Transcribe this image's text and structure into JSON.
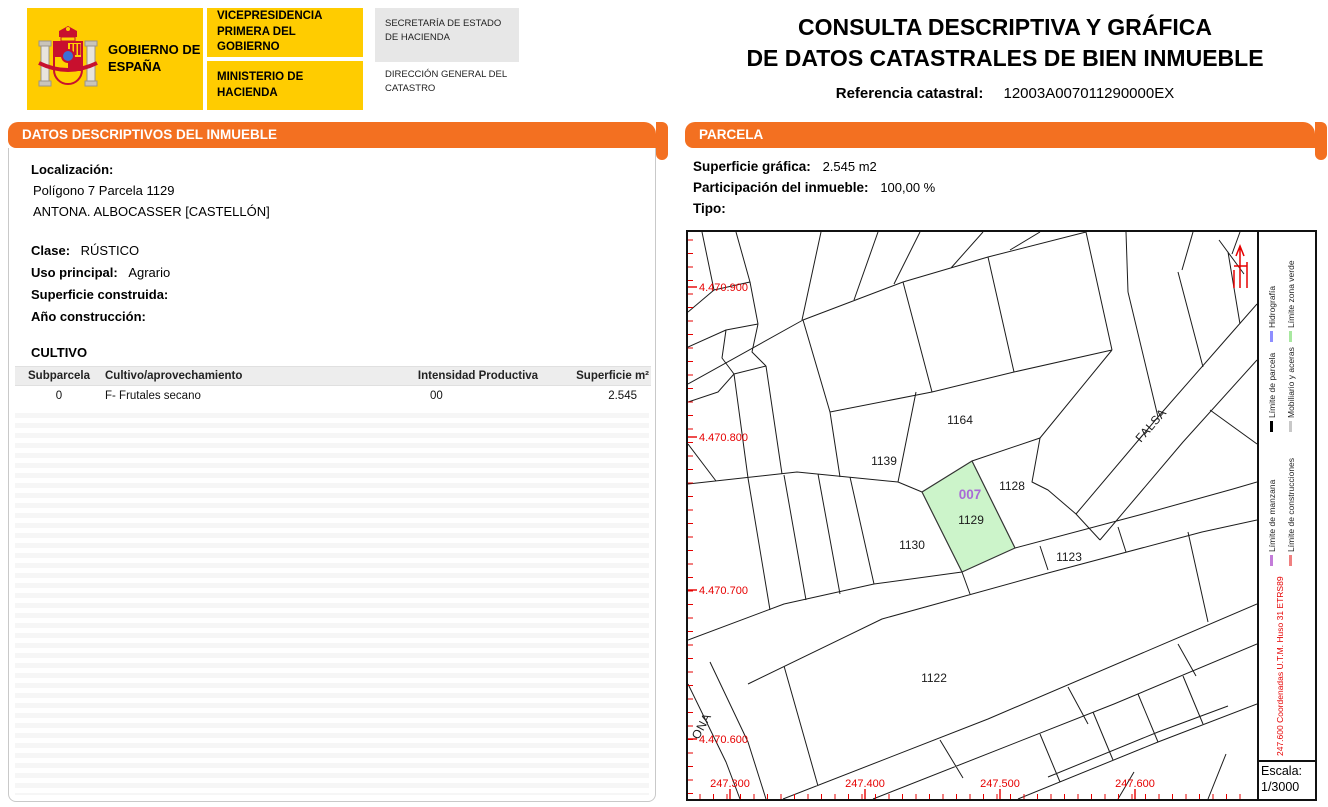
{
  "colors": {
    "accent_orange": "#F37021",
    "brand_yellow": "#FFCC00",
    "map_red": "#E60000",
    "parcel_green_fill": "#CCF4CA",
    "parcel_code_purple": "#A96AD6"
  },
  "header": {
    "gobierno": "GOBIERNO DE ESPAÑA",
    "vicepresidencia": "VICEPRESIDENCIA PRIMERA DEL GOBIERNO",
    "ministerio": "MINISTERIO DE HACIENDA",
    "secretaria": "SECRETARÍA DE ESTADO DE HACIENDA",
    "direccion": "DIRECCIÓN GENERAL DEL CATASTRO",
    "title_line1": "CONSULTA DESCRIPTIVA Y GRÁFICA",
    "title_line2": "DE DATOS CATASTRALES DE BIEN INMUEBLE",
    "ref_label": "Referencia catastral:",
    "ref_value": "12003A007011290000EX"
  },
  "left_panel": {
    "title": "DATOS DESCRIPTIVOS DEL INMUEBLE",
    "localizacion_label": "Localización:",
    "localizacion_line1": "Polígono 7 Parcela 1129",
    "localizacion_line2": "ANTONA. ALBOCASSER [CASTELLÓN]",
    "clase_label": "Clase:",
    "clase_value": "RÚSTICO",
    "uso_label": "Uso principal:",
    "uso_value": "Agrario",
    "superficie_label": "Superficie construida:",
    "superficie_value": "",
    "anio_label": "Año construcción:",
    "anio_value": "",
    "cultivo_title": "CULTIVO",
    "cultivo_table": {
      "headers": [
        "Subparcela",
        "Cultivo/aprovechamiento",
        "Intensidad Productiva",
        "Superficie m²"
      ],
      "rows": [
        [
          "0",
          "F- Frutales secano",
          "00",
          "2.545"
        ]
      ]
    }
  },
  "right_panel": {
    "title": "PARCELA",
    "superficie_label": "Superficie gráfica:",
    "superficie_value": "2.545 m2",
    "participacion_label": "Participación del inmueble:",
    "participacion_value": "100,00 %",
    "tipo_label": "Tipo:",
    "tipo_value": ""
  },
  "map": {
    "highlight": {
      "code": "007",
      "parcel": "1129"
    },
    "parcel_labels": [
      {
        "text": "1164",
        "x": 272,
        "y": 192
      },
      {
        "text": "1139",
        "x": 196,
        "y": 233
      },
      {
        "text": "1128",
        "x": 324,
        "y": 258
      },
      {
        "text": "1130",
        "x": 224,
        "y": 317
      },
      {
        "text": "1123",
        "x": 381,
        "y": 329
      },
      {
        "text": "1122",
        "x": 246,
        "y": 450
      }
    ],
    "code_label": {
      "text": "007",
      "x": 282,
      "y": 267
    },
    "parcel_label": {
      "text": "1129",
      "x": 283,
      "y": 292
    },
    "road_labels": [
      {
        "text": "FALSA",
        "x": 466,
        "y": 196,
        "rot": -49
      },
      {
        "text": "ONA",
        "x": 17,
        "y": 496,
        "rot": -62
      }
    ],
    "y_axis_labels": [
      {
        "text": "4.470.900",
        "y": 55
      },
      {
        "text": "4.470.800",
        "y": 205
      },
      {
        "text": "4.470.700",
        "y": 358
      },
      {
        "text": "4.470.600",
        "y": 507
      }
    ],
    "x_axis_labels": [
      {
        "text": "247.300",
        "x": 42
      },
      {
        "text": "247.400",
        "x": 177
      },
      {
        "text": "247.500",
        "x": 312
      },
      {
        "text": "247.600",
        "x": 447
      }
    ],
    "legend": [
      {
        "label": "Hidrografía",
        "color": "#8E8EFF"
      },
      {
        "label": "Límite zona verde",
        "color": "#A8E8A0"
      },
      {
        "label": "Límite de parcela",
        "color": "#000000"
      },
      {
        "label": "Mobiliario y aceras",
        "color": "#C8C8C8"
      },
      {
        "label": "Límite de manzana",
        "color": "#C37CD9"
      },
      {
        "label": "Límite de construcciones",
        "color": "#F08080"
      }
    ],
    "coords_note": "247.600 Coordenadas U.T.M. Huso 31 ETRS89",
    "escala_label": "Escala:",
    "escala_value": "1/3000"
  }
}
